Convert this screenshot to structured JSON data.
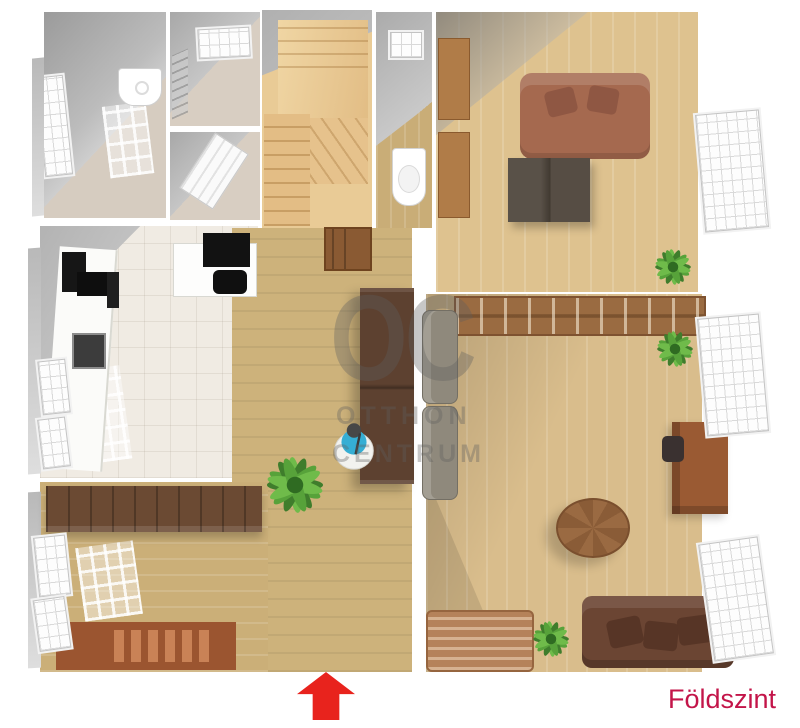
{
  "watermark": {
    "initials": "OC",
    "line1": "OTTHON",
    "line2": "CENTRUM"
  },
  "floor_label": {
    "text": "Földszint"
  },
  "entrance_arrow": {
    "direction": "up"
  },
  "colors": {
    "arrow_red": "#e8231d",
    "label_red": "#c31549",
    "watermark_gray": "rgba(95,95,95,0.35)",
    "wood_light": "#dec28f",
    "wood_mid": "#cdb27b",
    "stairs_wood": "#e9cb96",
    "kitchen_tile": "#f0ebe3",
    "sofa_brown": "#a5694f",
    "sofa_dark": "#6b4533",
    "furniture_brown": "#9a5a33",
    "wardrobe_brown": "#5d4130",
    "table_dark": "#4b4238",
    "gray_sofa": "#8f897c",
    "plant_green": "#4a8f33"
  }
}
